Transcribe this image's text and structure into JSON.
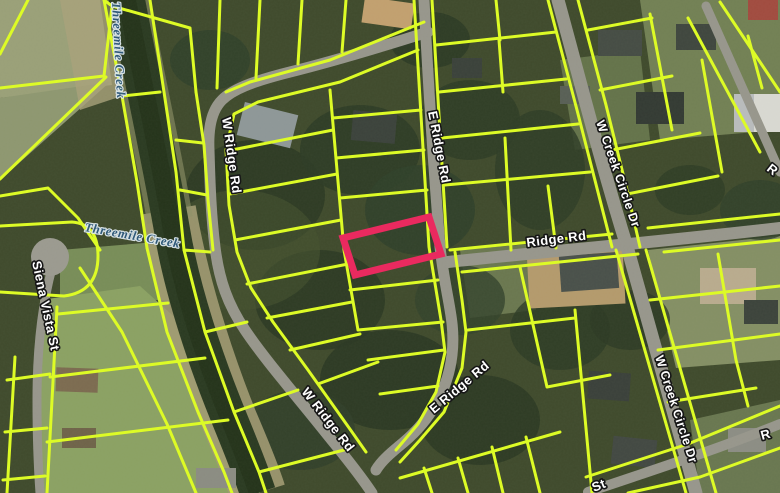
{
  "map": {
    "kind": "parcel-map-aerial-view",
    "labels": {
      "creek_top": "Threemile Creek",
      "creek_mid": "Threemile Creek",
      "w_ridge_rd_upper": "W Ridge Rd",
      "w_ridge_rd_lower": "W Ridge Rd",
      "e_ridge_rd_upper": "E Ridge Rd",
      "e_ridge_rd_lower": "E Ridge Rd",
      "ridge_rd": "Ridge Rd",
      "w_creek_circle_dr_upper": "W Creek Circle Dr",
      "w_creek_circle_dr_lower": "W Creek Circle Dr",
      "siena_vista_st": "Siena Vista St",
      "partial_edge_label_right_upper": "R",
      "partial_edge_label_right_lower": "R",
      "partial_edge_label_bottom": "St"
    },
    "colors": {
      "parcel_line": "#ddfb26",
      "highlight": "#e92a5f",
      "road_fill": "#97968c",
      "water": "#2a3a21",
      "road_label_fill": "#ffffff",
      "road_label_halo": "#161616",
      "water_label_fill": "#2f5a7d",
      "water_label_halo": "#dfe9ee"
    },
    "highlight_parcel": {
      "present": true,
      "shape": "rectangle",
      "location": "center, west side of E Ridge Rd"
    }
  }
}
